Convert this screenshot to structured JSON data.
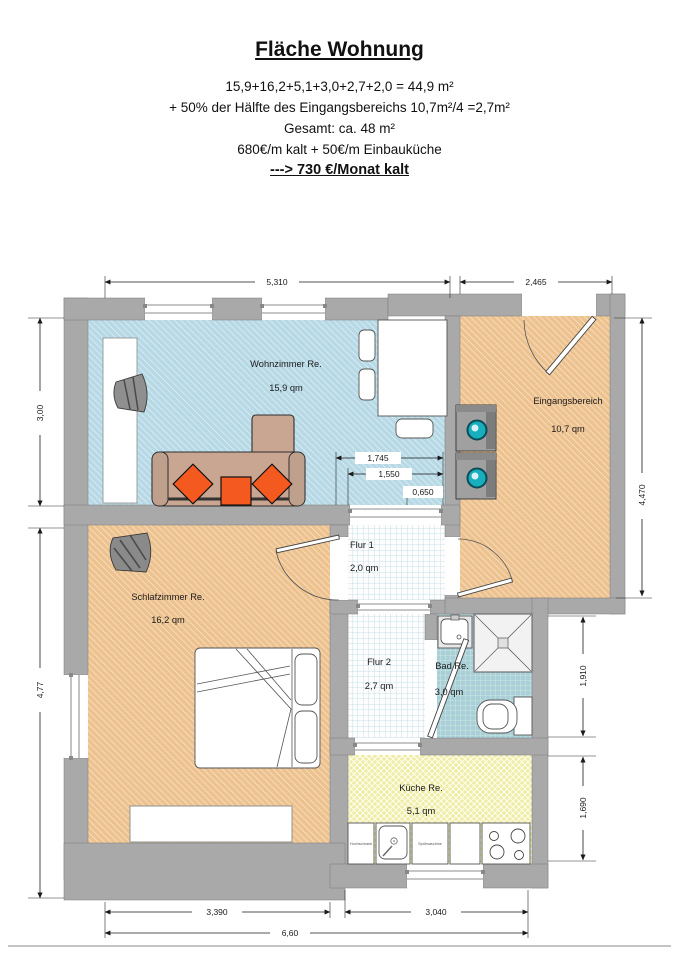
{
  "header": {
    "title": "Fläche Wohnung",
    "line1": "15,9+16,2+5,1+3,0+2,7+2,0 = 44,9 m²",
    "line2": "+ 50% der Hälfte des Eingangsbereichs 10,7m²/4 =2,7m²",
    "line3": "Gesamt: ca. 48 m²",
    "line4": "680€/m kalt + 50€/m Einbauküche",
    "line5": "---> 730 €/Monat kalt"
  },
  "rooms": {
    "wohnzimmer": {
      "name": "Wohnzimmer Re.",
      "area": "15,9 qm"
    },
    "eingangsbereich": {
      "name": "Eingangsbereich",
      "area": "10,7 qm"
    },
    "flur1": {
      "name": "Flur 1",
      "area": "2,0 qm"
    },
    "schlafzimmer": {
      "name": "Schlafzimmer Re.",
      "area": "16,2 qm"
    },
    "flur2": {
      "name": "Flur 2",
      "area": "2,7 qm"
    },
    "bad": {
      "name": "Bad Re.",
      "area": "3,0 qm"
    },
    "kueche": {
      "name": "Küche Re.",
      "area": "5,1 qm"
    }
  },
  "kitchen_units": {
    "tall_cabinet": "Hochschrank",
    "dishwasher": "Spülmaschine"
  },
  "dimensions": {
    "top_living": "5,310",
    "top_entrance": "2,465",
    "left_living_height": "3,00",
    "left_bedroom_height": "4,77",
    "right_entrance_height": "4,470",
    "right_bath_height": "1,910",
    "right_kitchen_height": "1,690",
    "inner_opening_a": "1,745",
    "inner_opening_b": "1,550",
    "inner_opening_c": "0,650",
    "bottom_bedroom": "3,390",
    "bottom_kitchen": "3,040",
    "bottom_total": "6,60"
  },
  "colors": {
    "wall": "#a9a9a9",
    "living_room": "#b7d9e6",
    "entrance": "#edc28e",
    "bedroom": "#edc28e",
    "hall_floor": "#fdfdfd",
    "bath_floor": "#a9cfd9",
    "kitchen_floor": "#efeda4",
    "sofa": "#c9a691",
    "pillow": "#f4591f",
    "washer_door": "#17aebe"
  }
}
